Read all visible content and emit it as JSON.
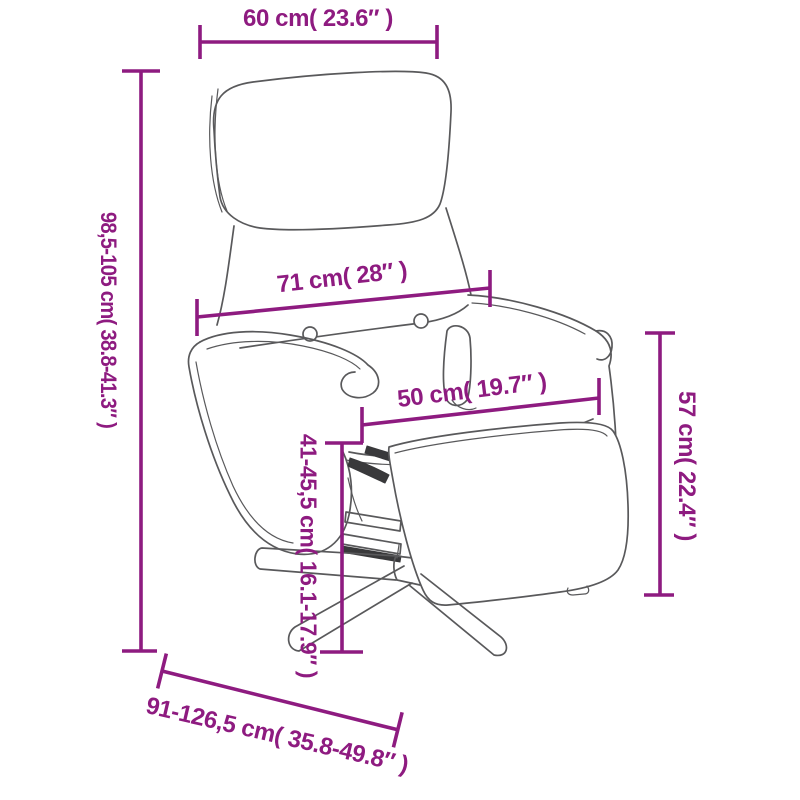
{
  "colors": {
    "dimension": "#8e1b80",
    "outline": "#59595b",
    "dark": "#39393b",
    "background": "#ffffff"
  },
  "illustration": {
    "description": "Line drawing of a recliner armchair with headrest cushion, two tufting buttons, swivel star base and extended footrest"
  },
  "dimensions": {
    "headrest_width": {
      "label": "60 cm( 23.6″ )"
    },
    "total_height": {
      "label": "98,5-105 cm( 38.8-41.3″ )"
    },
    "backrest_width": {
      "label": "71 cm( 28″ )"
    },
    "seat_width": {
      "label": "50 cm( 19.7″ )"
    },
    "footrest_height": {
      "label": "57 cm( 22.4″ )"
    },
    "seat_height": {
      "label": "41-45,5 cm( 16.1-17.9″ )"
    },
    "total_depth": {
      "label": "91-126,5 cm( 35.8-49.8″ )"
    }
  }
}
